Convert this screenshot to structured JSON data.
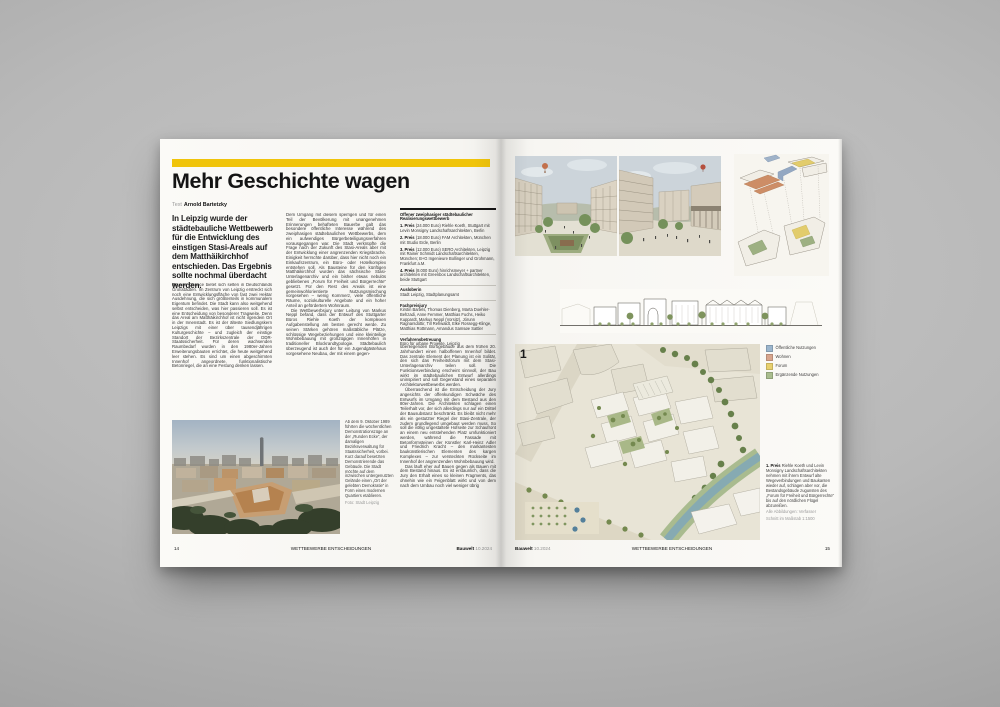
{
  "meta": {
    "issue_name": "Bauwelt",
    "issue_no": "10.2024",
    "section": "WETTBEWERBE ENTSCHEIDUNGEN",
    "page_left": "14",
    "page_right": "15"
  },
  "colors": {
    "accent_yellow": "#f0c40a",
    "backdrop_gray": "#b4b4b4",
    "paper": "#f8f7f3"
  },
  "article": {
    "title": "Mehr Geschichte wagen",
    "byline_label": "Text",
    "author": "Arnold Bartetzky",
    "intro": "In Leipzig wurde der städtebauliche Wettbewerb für die Entwicklung des einstigen Stasi-Areals auf dem Matthäikirchhof entschieden. Das Ergebnis sollte nochmal überdacht werden.",
    "col1_lead": "So",
    "col1_body": "eine Chance bietet sich selten in Deutschlands Großstädten. Im Zentrum von Leipzig erstreckt sich noch eine Entwicklungsfläche von fast zwei Hektar Ausdehnung, die sich größtenteils in kommunalem Eigentum befindet. Die Stadt kann also weitgehend selbst entscheiden, was hier passieren soll. Es ist eine Entscheidung von besonderer Tragweite. Denn das Areal am Matthäikirchhof ist nicht irgendein Ort in der Innenstadt. Es ist der älteste Siedlungskern Leipzigs mit einer über tausendjährigen Kulturgeschichte – und zugleich der einstige Standort der Bezirkszentrale der DDR-Staatssicherheit. Für deren wachsenden Raumbedarf wurden in den 1980er-Jahren Erweiterungsbauten errichtet, die heute weitgehend leer stehen. Es sind um einen abgeschirmten Innenhof angeordnete, funktionalistische Betonriegel, die an eine Festung denken lassen.",
    "col2_p1": "Dem Umgang mit diesem sperrigen und für einen Teil der Bevölkerung mit unangenehmen Erinnerungen behafteten Bauerbe galt das besondere öffentliche Interesse während des zweiphasigen städtebaulichen Wettbewerbs, dem ein aufwendiges Bürgerbeteiligungsverfahren vorausgegangen war. Die Stadt verknüpfte die Frage nach der Zukunft des Stasi-Areals aber mit der Entwicklung einer angrenzenden Kriegsbrache. Einigkeit herrschte darüber, dass hier nicht noch ein Einkaufszentrum, ein Büro- oder Hotelkomplex entstehen soll. Als Bausteine für den künftigen Matthäikirchhof wurden das sächsische Stasi-Unterlagenarchiv und ein bisher etwas nebulös gebliebenes „Forum für Freiheit und Bürgerrechte“ gesetzt. Für den Rest des Areals ist eine gemeinwohlorientierte Nutzungsmischung vorgesehen – wenig Kommerz, viele öffentliche Räume, soziokulturelle Angebote und ein hoher Anteil an gefördertem Wohnraum.",
    "col2_p2": "Die Wettbewerbsjury unter Leitung von Markus Neppl befand, dass der Entwurf des Stuttgarter Büros Riehle Koeth der komplexen Aufgabenstellung am besten gerecht werde. Zu seinen Stärken gehören maßstäbliche Plätze, schlüssige Wegebeziehungen und eine kleinteilige Wohnbebauung mit großzügigen Innenhöfen in traditioneller Blockrandtypologie. Städtebaulich überzeugend ist auch der für ein Jugendgästehaus vorgesehene Neubau, der mit einem gegen-",
    "col3_p1": "überliegenden Bürogebäude aus dem frühen 20. Jahrhundert einen halboffenen Innenhof bildet. Das zentrale Element der Planung ist ein Solitär, den sich das Freiheitsforum mit dem Stasi-Unterlagenarchiv teilen soll. Die Funktionsverbindung erscheint sinnvoll, der Bau wirkt im städtebaulichen Entwurf allerdings uninspiriert und soll Gegenstand eines separaten Architekturwettbewerbs werden.",
    "col3_p2": "Überraschend ist die Entscheidung der Jury angesichts der offenkundigen Schwäche des Entwurfs im Umgang mit dem Bestand aus den 80er-Jahren. Die Architekten schlagen einen Teilerhalt vor, der sich allerdings nur auf ein Drittel der Bausubstanz beschränkt. Es bleibt nicht mehr als ein gestutzter Riegel der Stasi-Zentrale, der zudem grundlegend umgebaut werden muss. So soll die völlig ungestaltete Hofseite zur Schaufront an einem neu entstehenden Platz umfunktioniert werden, während die Fassade mit Betonformsteinen der Künstler Karl-Heinz Adler und Friedrich Kracht – den markantesten baukünstlerischen Elementen des kargen Komplexes – zur versteckten Rückseite im Innenhof der angrenzenden Wohnbebauung wird.",
    "col3_p3": "Das läuft eher auf Bauen gegen als Bauen mit dem Bestand hinaus. Es ist erstaunlich, dass die Jury den Erhalt eines so kleinen Fragments, das ohnehin wie ein Feigenblatt wirkt und von dem nach dem Umbau noch viel weniger übrig"
  },
  "photo_caption": {
    "text": "Ab dem 9. Oktober 1989 führten die wöchentlichen Demonstrationszüge an der „Runden Ecke“, der damaligen Bezirksverwaltung für Staatssicherheit, vorbei. Kurz darauf besetzten Demonstrierende das Gebäude. Die Stadt möchte auf dem inzwischen untergenutzten Gelände einen „Ort der gelebten Demokratie“ in Form eines modernen Quartiers etablieren.",
    "credit": "Foto: Stadt Leipzig"
  },
  "infobox": {
    "title": "Offener zweiphasiger städtebaulicher Realisierungswettbewerb",
    "prizes": [
      {
        "label": "1. Preis",
        "text": "(24.000 Euro) Riehle Koeth, Stuttgart mit Levin Monsigny Landschaftsarchitekten, Berlin"
      },
      {
        "label": "2. Preis",
        "text": "(18.000 Euro) FAM Architekten, München mit Studio Erde, Berlin"
      },
      {
        "label": "3. Preis",
        "text": "(12.000 Euro) SERO Architekten, Leipzig mit Rainer Schmidt Landschaftsarchitekten, München; B+G Ingenieure Bollinger und Grohmann, Frankfurt a.M."
      },
      {
        "label": "4. Preis",
        "text": "(8.000 Euro) hinrichsmeyer + partner architekten mit Greenbox Landschaftsarchitekten, beide Stuttgart"
      }
    ],
    "sections": [
      {
        "heading": "Ausloberin",
        "text": "Stadt Leipzig, Stadtplanungsamt"
      },
      {
        "heading": "Fachpreisjury",
        "text": "Kirstin Bartels, Thomas Dienberg, Marta Doehler-Behzadi, Anne Femmer, Matthias Fuchs, Heiko Kuppardt, Markus Neppl (Vorsitz), Jórunn Ragnarsdóttir, Till Rehwaldt, Elke Rossegg-Klinge, Matthias Rottmann, Amandus Samsøe Sattler"
      },
      {
        "heading": "Verfahrensbetreuung",
        "text": "Büro für urbane Projekte, Leipzig"
      }
    ]
  },
  "right_page": {
    "figure_marker": "1",
    "legend": [
      {
        "label": "Öffentliche Nutzungen",
        "color": "#9bb5cd"
      },
      {
        "label": "Wohnen",
        "color": "#d8a58d"
      },
      {
        "label": "Forum",
        "color": "#e8d06e"
      },
      {
        "label": "Ergänzende Nutzungen",
        "color": "#a9bd8e"
      }
    ],
    "caption": {
      "label": "1. Preis",
      "text": "Riehle Koeth und Levin Monsigny Landschaftsarchitekten nehmen mit ihrem Entwurf alte Wegeverbindungen und Baukanten wieder auf, schlagen aber vor, die Bestandsgebäude zugunsten des „Forum für Freiheit und Bürgerrechte“ bis auf den nördlichen Flügel abzureißen.",
      "credit1": "Alle Abbildungen: Verfasser",
      "credit2": "Schnitt im Maßstab 1:1500"
    }
  }
}
